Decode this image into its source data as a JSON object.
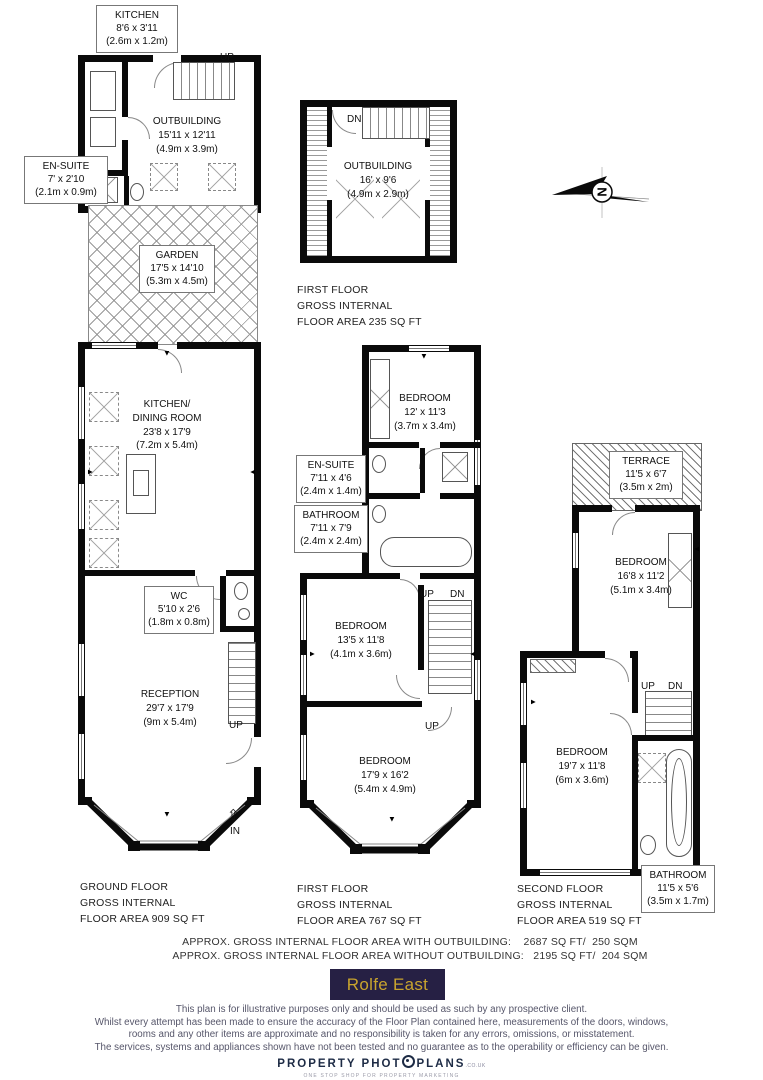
{
  "rooms": {
    "ob_kitchen": {
      "name": "KITCHEN",
      "imp": "8'6 x 3'11",
      "met": "(2.6m x 1.2m)"
    },
    "ob_ensuite": {
      "name": "EN-SUITE",
      "imp": "7' x 2'10",
      "met": "(2.1m x 0.9m)"
    },
    "ob_ground": {
      "name": "OUTBUILDING",
      "imp": "15'11 x 12'11",
      "met": "(4.9m x 3.9m)"
    },
    "garden": {
      "name": "GARDEN",
      "imp": "17'5 x 14'10",
      "met": "(5.3m x 4.5m)"
    },
    "ob_first": {
      "name": "OUTBUILDING",
      "imp": "16' x 9'6",
      "met": "(4.9m x 2.9m)"
    },
    "kitchen_dining": {
      "name": "KITCHEN/",
      "name2": "DINING ROOM",
      "imp": "23'8 x 17'9",
      "met": "(7.2m x 5.4m)"
    },
    "wc": {
      "name": "WC",
      "imp": "5'10 x 2'6",
      "met": "(1.8m x 0.8m)"
    },
    "reception": {
      "name": "RECEPTION",
      "imp": "29'7 x 17'9",
      "met": "(9m x 5.4m)"
    },
    "ff_bedroom1": {
      "name": "BEDROOM",
      "imp": "12' x 11'3",
      "met": "(3.7m x 3.4m)"
    },
    "ff_ensuite": {
      "name": "EN-SUITE",
      "imp": "7'11 x 4'6",
      "met": "(2.4m x 1.4m)"
    },
    "ff_bathroom": {
      "name": "BATHROOM",
      "imp": "7'11 x 7'9",
      "met": "(2.4m x 2.4m)"
    },
    "ff_bedroom2": {
      "name": "BEDROOM",
      "imp": "13'5 x 11'8",
      "met": "(4.1m x 3.6m)"
    },
    "ff_bedroom3": {
      "name": "BEDROOM",
      "imp": "17'9 x 16'2",
      "met": "(5.4m x 4.9m)"
    },
    "terrace": {
      "name": "TERRACE",
      "imp": "11'5 x 6'7",
      "met": "(3.5m x 2m)"
    },
    "sf_bedroom1": {
      "name": "BEDROOM",
      "imp": "16'8 x 11'2",
      "met": "(5.1m x 3.4m)"
    },
    "sf_bedroom2": {
      "name": "BEDROOM",
      "imp": "19'7 x 11'8",
      "met": "(6m x 3.6m)"
    },
    "sf_bathroom": {
      "name": "BATHROOM",
      "imp": "11'5 x 5'6",
      "met": "(3.5m x 1.7m)"
    }
  },
  "captions": {
    "ground": [
      "GROUND FLOOR",
      "GROSS INTERNAL",
      "FLOOR AREA 909 SQ FT"
    ],
    "first_outbuilding": [
      "FIRST FLOOR",
      "GROSS INTERNAL",
      "FLOOR AREA 235 SQ FT"
    ],
    "first": [
      "FIRST FLOOR",
      "GROSS INTERNAL",
      "FLOOR AREA 767 SQ FT"
    ],
    "second": [
      "SECOND FLOOR",
      "GROSS INTERNAL",
      "FLOOR AREA 519 SQ FT"
    ]
  },
  "stair_labels": {
    "up": "UP",
    "dn": "DN",
    "in": "IN",
    "in_arrow": "⇧"
  },
  "compass": {
    "north": "N"
  },
  "totals": {
    "line1": "APPROX. GROSS INTERNAL FLOOR AREA WITH OUTBUILDING:    2687 SQ FT/  250 SQM",
    "line2": "APPROX. GROSS INTERNAL FLOOR AREA WITHOUT OUTBUILDING:   2195 SQ FT/  204 SQM"
  },
  "branding": {
    "agent_logo_text": "Rolfe East",
    "agent_logo_bg": "#262044",
    "agent_logo_color": "#c9a42e"
  },
  "disclaimer": [
    "This plan is for illustrative purposes only and should be used as such by any prospective client.",
    "Whilst every attempt has been made to ensure the accuracy of the Floor Plan contained here, measurements of the doors, windows,",
    "rooms and any other items are approximate and no responsibility is taken for any errors, omissions, or misstatement.",
    "The services, systems and appliances shown have not been tested and no guarantee as to the operability or efficiency can be given."
  ],
  "footer_logo": {
    "part1": "PROPERTY PHOT",
    "part2": "PLANS",
    "suffix": ".CO.UK",
    "tagline": "ONE STOP SHOP FOR PROPERTY MARKETING",
    "icon": "camera-aperture-icon"
  }
}
